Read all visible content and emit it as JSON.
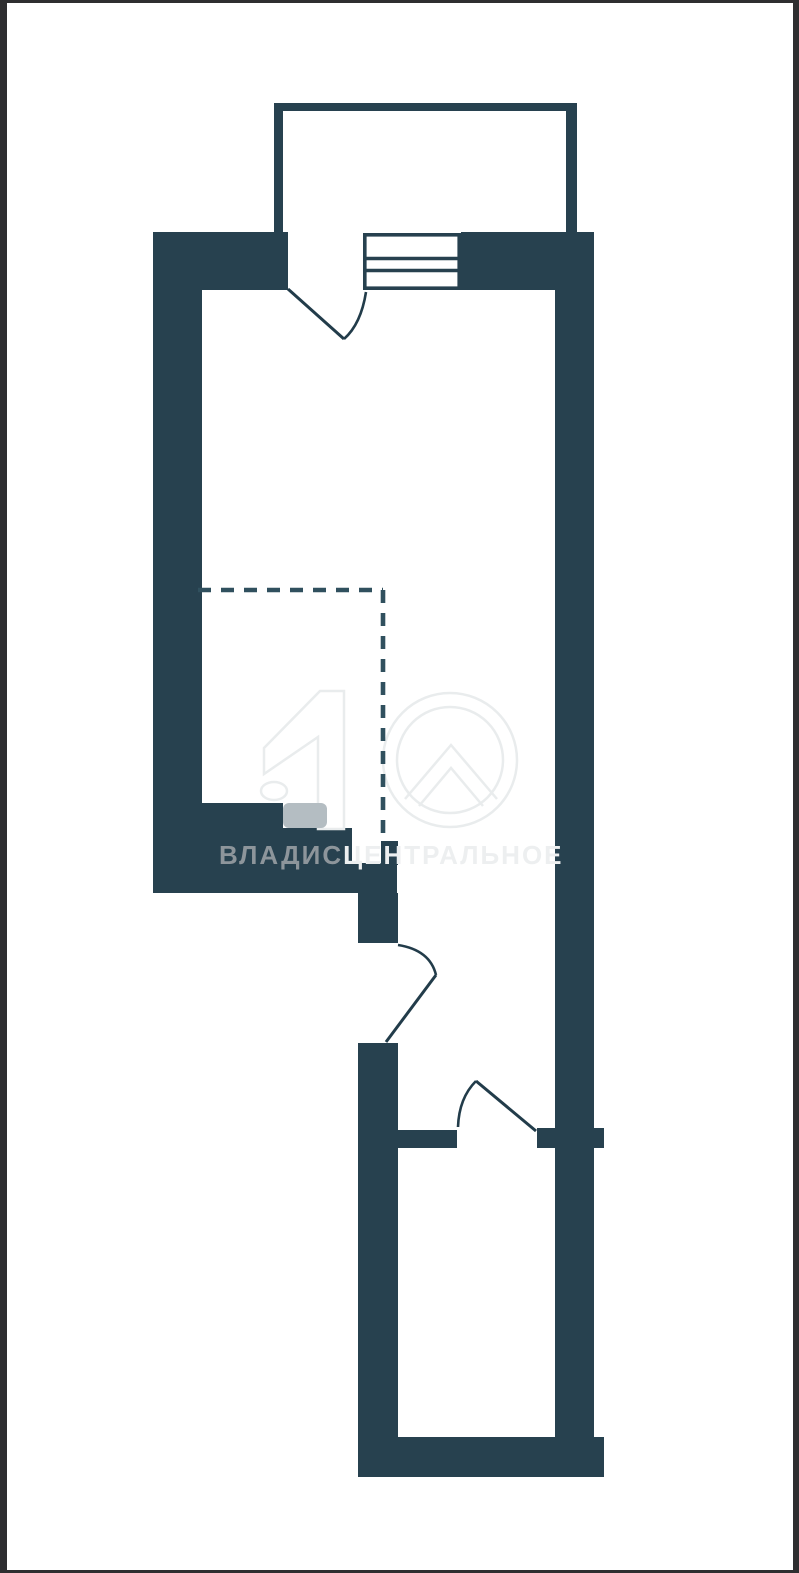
{
  "page": {
    "kind": "apartment-floor-plan-screenshot",
    "background_color": "#ffffff",
    "frame_color": "#2e2e30"
  },
  "floor_plan": {
    "wall_color": "#27414f",
    "line_color": "#27414f",
    "dashed_boundary_color": "#30505e",
    "features": [
      "balcony-top",
      "balcony-door-swing",
      "window-triple-line",
      "upper-room",
      "dashed-zone-boundary",
      "wall-step",
      "interior-door-swing-1",
      "interior-door-swing-2",
      "bottom-room"
    ]
  },
  "watermark": {
    "brand_part1": "ВЛАДИС",
    "brand_part2": "ЦЕНТРАЛЬНОЕ",
    "full_text": "ВЛАДИСЦЕНТРАЛЬНОЕ",
    "text_color_primary": "#8d959b",
    "text_color_secondary": "#edeff0",
    "logo_name": "house-number-10-logo",
    "logo_outline_color": "#e9eced",
    "logo_square_color": "#b4bdc2"
  }
}
